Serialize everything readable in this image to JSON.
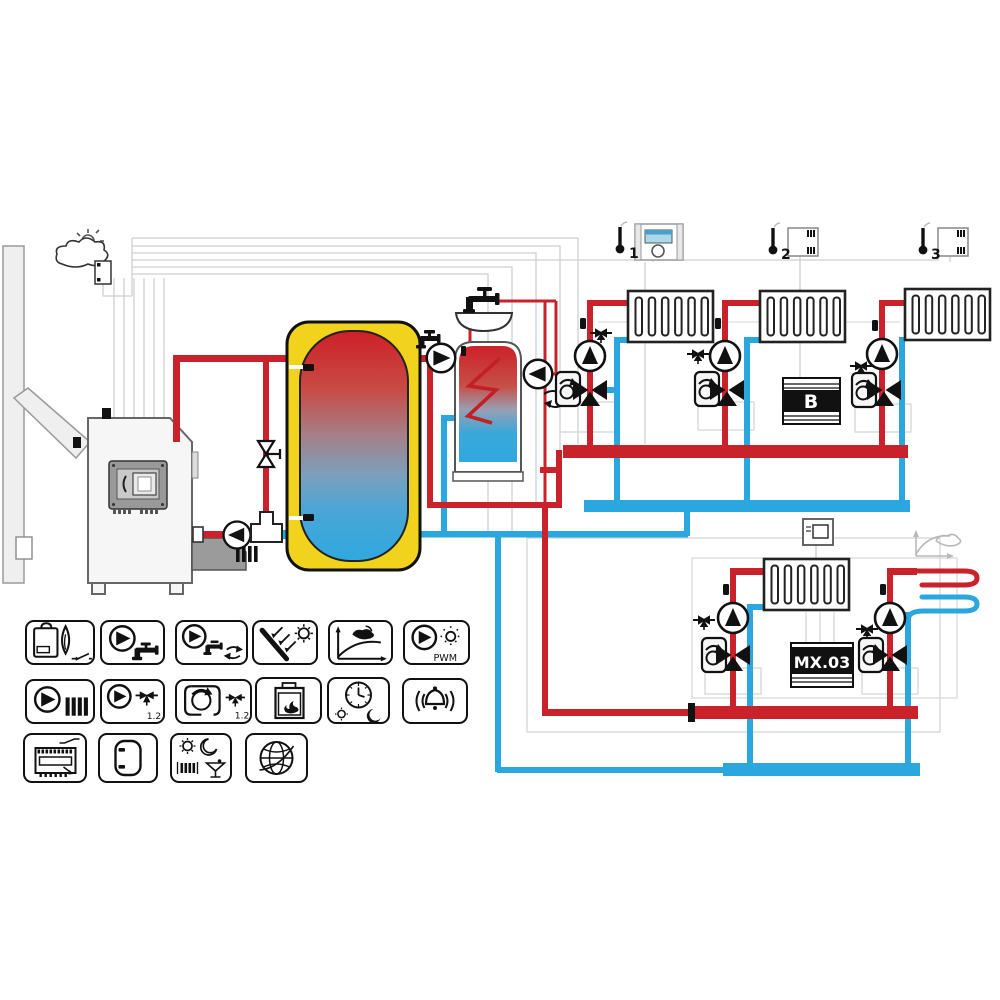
{
  "app": {
    "type": "heating-system-schematic"
  },
  "colors": {
    "pipe_red": "#c9222a",
    "pipe_blue": "#2aa7de",
    "buffer_yellow": "#f1d21c",
    "screen_blue": "#a9d9ea",
    "wire_gray": "#cfcfcf",
    "device_black": "#111111"
  },
  "labels": {
    "zone1": "1",
    "zone2": "2",
    "zone3": "3",
    "module_b": "B",
    "module_mx": "MX.03"
  },
  "toolbox": {
    "rows": [
      [
        {
          "id": "boiler-burner",
          "name": "boiler with burner contact"
        },
        {
          "id": "dhw-pump",
          "name": "domestic hot water pump"
        },
        {
          "id": "dhw-circulation-pump",
          "name": "DHW circulation pump"
        },
        {
          "id": "solar-collector",
          "name": "solar collector"
        },
        {
          "id": "heating-curve",
          "name": "weather heating curve"
        },
        {
          "id": "pwm-pump",
          "name": "PWM controlled pump",
          "label": "PWM"
        }
      ],
      [
        {
          "id": "heating-pump",
          "name": "heating circuit pump"
        },
        {
          "id": "mixed-circuit-pump",
          "name": "mixed circuit pump",
          "label": "1.2"
        },
        {
          "id": "mixer-actuator",
          "name": "mixing valve actuator",
          "label": "1.2"
        },
        {
          "id": "solid-fuel-stove",
          "name": "fireplace / stove"
        },
        {
          "id": "time-program",
          "name": "day-night time program"
        },
        {
          "id": "alarm",
          "name": "alarm"
        }
      ],
      [
        {
          "id": "relay-module",
          "name": "controller relay module"
        },
        {
          "id": "buffer-tank",
          "name": "buffer tank"
        },
        {
          "id": "operating-modes",
          "name": "comfort and party modes"
        },
        {
          "id": "internet",
          "name": "internet connection"
        }
      ]
    ]
  }
}
